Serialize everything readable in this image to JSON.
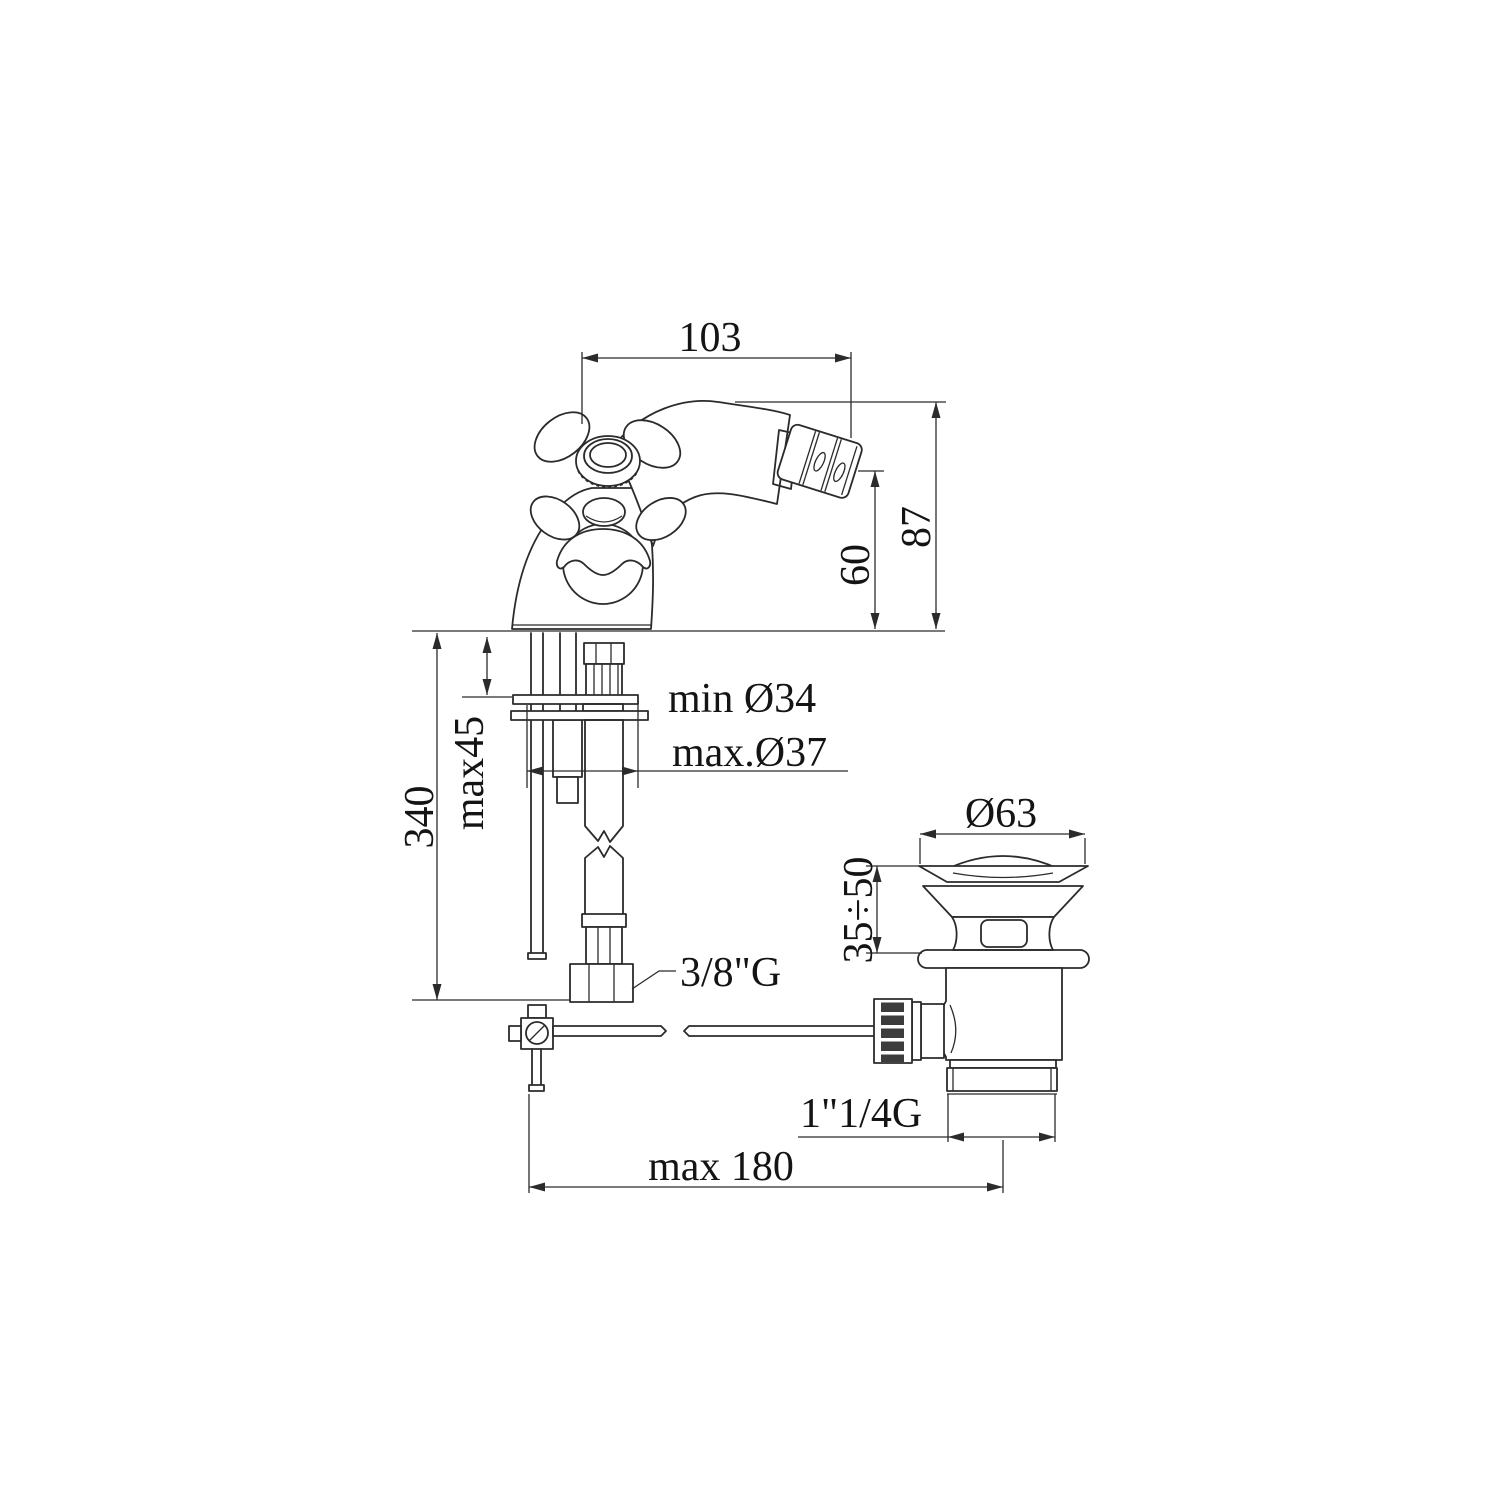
{
  "drawing": {
    "type": "technical-dimension-drawing",
    "subject": "bidet mixer tap with pop-up waste"
  },
  "dims": {
    "spout_reach": "103",
    "height_total": "87",
    "height_outlet": "60",
    "supply_length": "340",
    "deck_thickness": "max45",
    "hole_min": "min Ø34",
    "hole_max": "max.Ø37",
    "supply_thread": "3/8\"G",
    "waste_flange": "Ø63",
    "waste_range": "35÷50",
    "waste_thread": "1\"1/4G",
    "rod_reach": "max 180"
  }
}
